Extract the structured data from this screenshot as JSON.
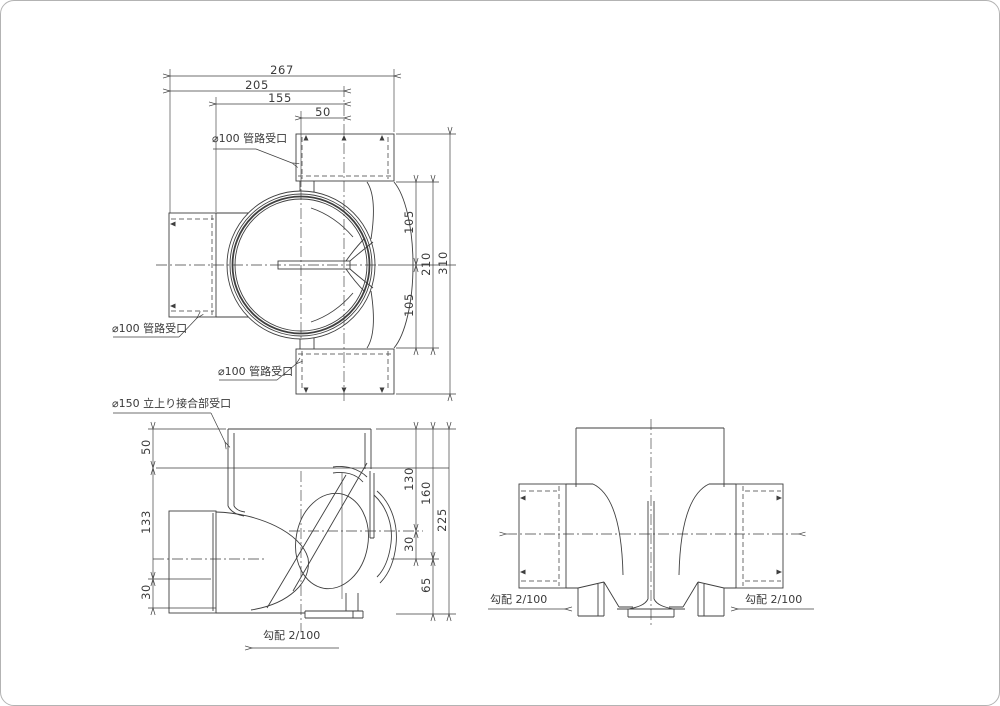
{
  "drawing": {
    "colors": {
      "line": "#3f3f3f",
      "background": "#ffffff"
    },
    "plan_view": {
      "dim_267": "267",
      "dim_205": "205",
      "dim_155": "155",
      "dim_50": "50",
      "dim_105_top": "105",
      "dim_105_bottom": "105",
      "dim_210": "210",
      "dim_310": "310",
      "label_top_socket": "⌀100 管路受口",
      "label_left_socket": "⌀100 管路受口",
      "label_bottom_socket": "⌀100 管路受口"
    },
    "front_view": {
      "label_riser": "⌀150 立上り接合部受口",
      "dim_50": "50",
      "dim_133": "133",
      "dim_30_left": "30",
      "dim_130": "130",
      "dim_30_right": "30",
      "dim_160": "160",
      "dim_65": "65",
      "dim_225": "225",
      "slope_label": "勾配 2/100"
    },
    "side_view": {
      "slope_label_left": "勾配 2/100",
      "slope_label_right": "勾配 2/100"
    }
  }
}
